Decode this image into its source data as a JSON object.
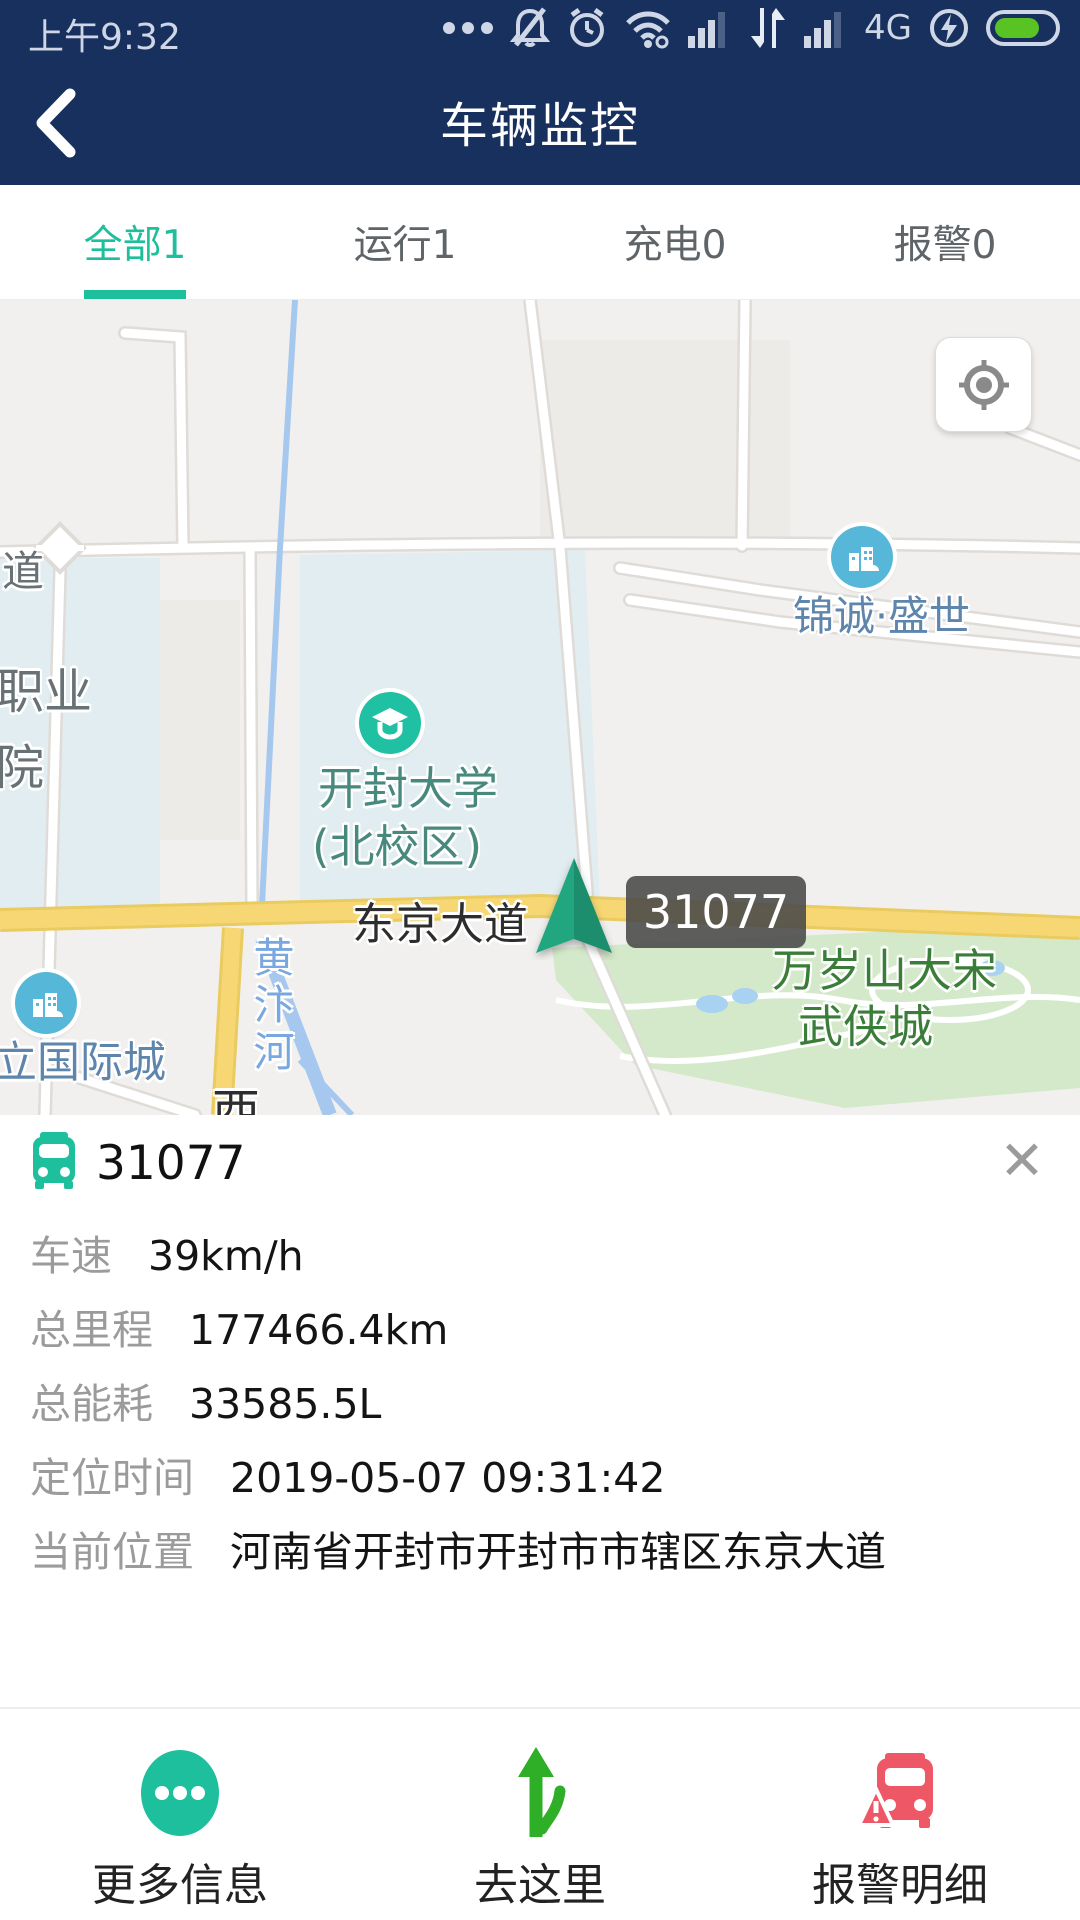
{
  "status_bar": {
    "time": "上午9:32",
    "network": "4G"
  },
  "header": {
    "title": "车辆监控"
  },
  "tabs": {
    "items": [
      {
        "label": "全部1",
        "active": true
      },
      {
        "label": "运行1",
        "active": false
      },
      {
        "label": "充电0",
        "active": false
      },
      {
        "label": "报警0",
        "active": false
      }
    ]
  },
  "map": {
    "vehicle_tooltip": "31077",
    "poi": {
      "jincheng": "锦诚·盛世",
      "university_line1": "开封大学",
      "university_line2": "(北校区)",
      "liguoji": "立国际城"
    },
    "road_labels": {
      "dao": "道",
      "zhiye": "职业",
      "yuan": "院",
      "dongjing": "东京大道",
      "huangbian": "黄汴河",
      "xi": "西"
    },
    "park_line1": "万岁山大宋",
    "park_line2": "武侠城"
  },
  "panel": {
    "vehicle_id": "31077",
    "close_icon": "✕",
    "rows": [
      {
        "label": "车速",
        "value": "39km/h"
      },
      {
        "label": "总里程",
        "value": "177466.4km"
      },
      {
        "label": "总能耗",
        "value": "33585.5L"
      },
      {
        "label": "定位时间",
        "value": "2019-05-07 09:31:42"
      },
      {
        "label": "当前位置",
        "value": "河南省开封市开封市市辖区东京大道"
      }
    ]
  },
  "bottom_bar": {
    "items": [
      {
        "label": "更多信息"
      },
      {
        "label": "去这里"
      },
      {
        "label": "报警明细"
      }
    ]
  },
  "colors": {
    "navy": "#18305d",
    "accent_teal": "#1ebf9c",
    "poi_blue": "#57b7d8",
    "alarm_red": "#ee5866",
    "nav_green": "#2fae27",
    "battery_green": "#58c322",
    "road_yellow": "#f7d774",
    "park_green": "#d4e9ca",
    "campus_blue": "#e1edf0"
  }
}
